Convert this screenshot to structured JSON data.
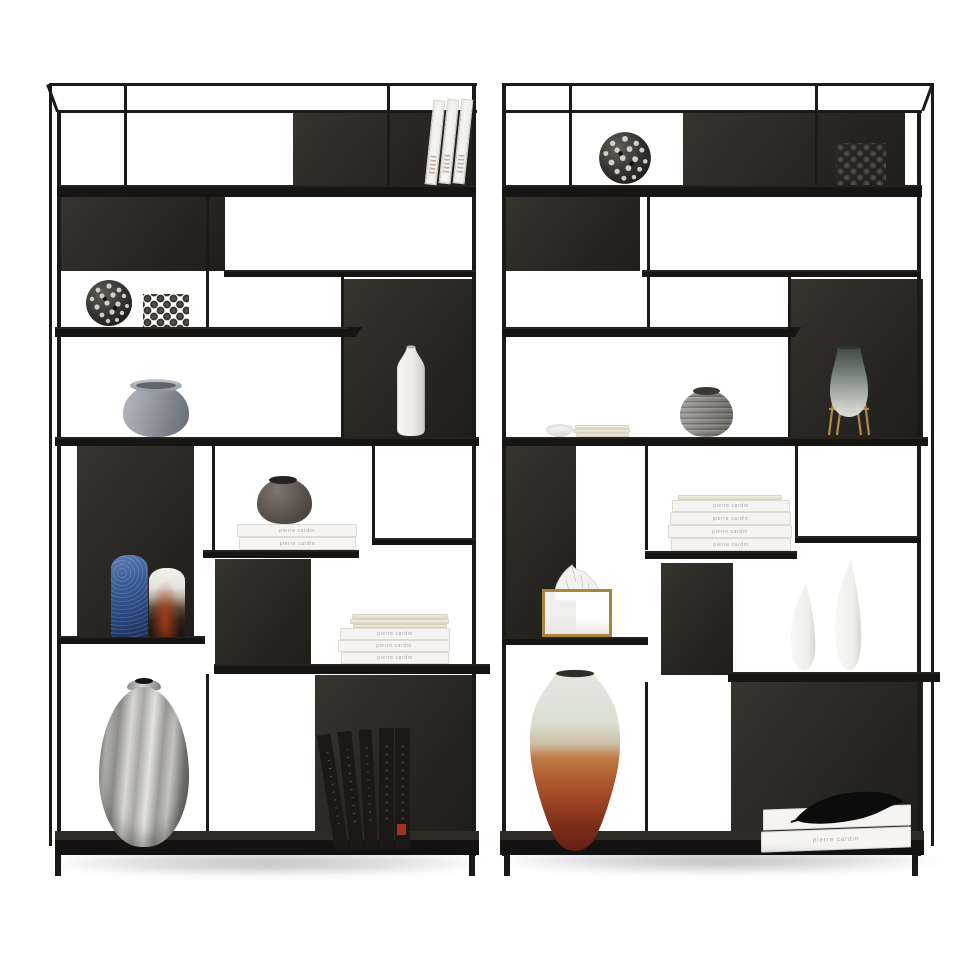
{
  "scene": {
    "type": "product-photograph",
    "subject": "Two matching black metal open etagere bookshelf display units styled with decorative objects",
    "background_color": "#ffffff",
    "floor_shadow": "soft grey under each unit"
  },
  "palette": {
    "frame_black": "#1b1a18",
    "panel_charcoal": "#2b2925",
    "shelf_black": "#161514",
    "gold_accent": "#a8853f",
    "book_spine_text": "#a9a49d",
    "blue_vase": "#2e4c85",
    "rust_vase": "#9c4526",
    "silver_vase": "#b9b8b4",
    "smoked_glass": "#5a655f"
  },
  "books": {
    "spine_text": "pierre cardin"
  },
  "units": [
    {
      "id": "left-bookshelf",
      "decor": [
        "three white leaning books on top shelf",
        "perforated metal sphere ornament",
        "diagonal pin-stud sculpture",
        "blue-grey glass jar",
        "white bottle vase",
        "taupe round vase on two white books",
        "blue mottled vase",
        "black and white ombre vase",
        "stack of white books with papers",
        "silver metallic oval vase",
        "five leaning black books"
      ]
    },
    {
      "id": "right-bookshelf",
      "decor": [
        "perforated metal sphere ornament",
        "stud ball grid sculpture",
        "small white bowl and note papers",
        "ribbed grey vase",
        "smoked glass vase on gold stand",
        "stack of four white books",
        "gold wire tissue box holder with tissue",
        "two white gourd vases",
        "sage-to-rust ombre floor vase",
        "two white books with black feather"
      ]
    }
  ]
}
